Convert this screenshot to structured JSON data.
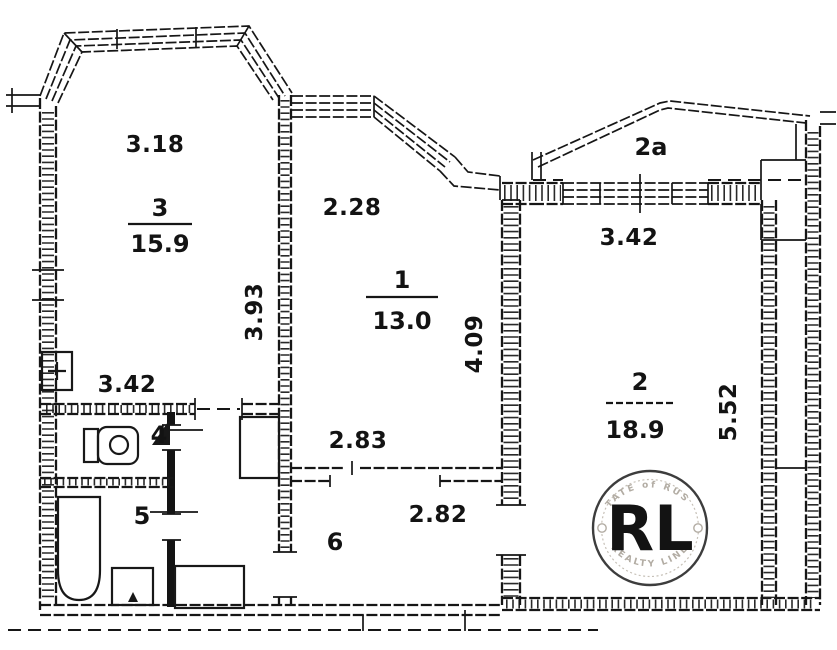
{
  "plan": {
    "rooms": {
      "room1": {
        "number": "1",
        "area": "13.0"
      },
      "room2": {
        "number": "2",
        "area": "18.9"
      },
      "room3": {
        "number": "3",
        "area": "15.9"
      },
      "wc": {
        "number": "4"
      },
      "bath": {
        "number": "5"
      },
      "hall": {
        "number": "6"
      },
      "balcony": {
        "number": "2a"
      }
    },
    "dims": {
      "room3_width": "3.18",
      "room3_depth": "3.93",
      "room3_bottom": "3.42",
      "room1_top": "2.28",
      "room1_bottom": "2.83",
      "room1_depth": "4.09",
      "room2_width": "3.42",
      "room2_depth": "5.52",
      "hall_width": "2.82"
    },
    "ink_color": "#161616",
    "paper_color": "#ffffff"
  },
  "watermark": {
    "arc_top": "ESTATE of RUSSIA",
    "monogram": "RL",
    "arc_bottom": "REALTY LINE",
    "gold_color": "#c09a47",
    "ring_color": "#3d3d3d",
    "gray_text_color": "#b2aca3"
  }
}
